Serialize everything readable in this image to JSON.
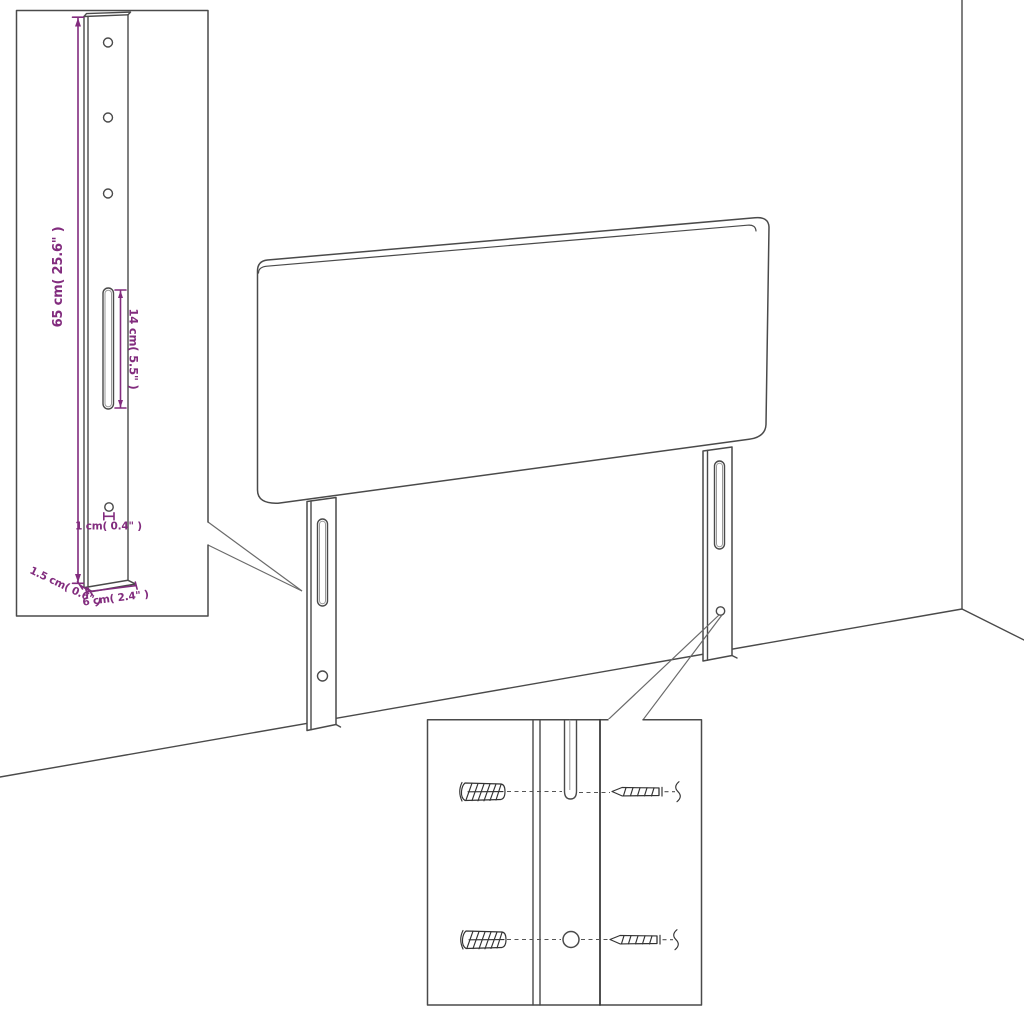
{
  "diagram": {
    "subject": "headboard-with-mounting-legs-assembly-diagram",
    "background": "#ffffff",
    "line_color": "#4a4a4a",
    "dimension_color": "#822c7e",
    "bracket_detail": {
      "height": "65 cm( 25.6\" )",
      "slot_length": "14 cm( 5.5\" )",
      "hole_diameter": "1 cm( 0.4\" )",
      "thickness": "1.5 cm( 0.6\" )",
      "width": "6 cm( 2.4\" )"
    }
  }
}
